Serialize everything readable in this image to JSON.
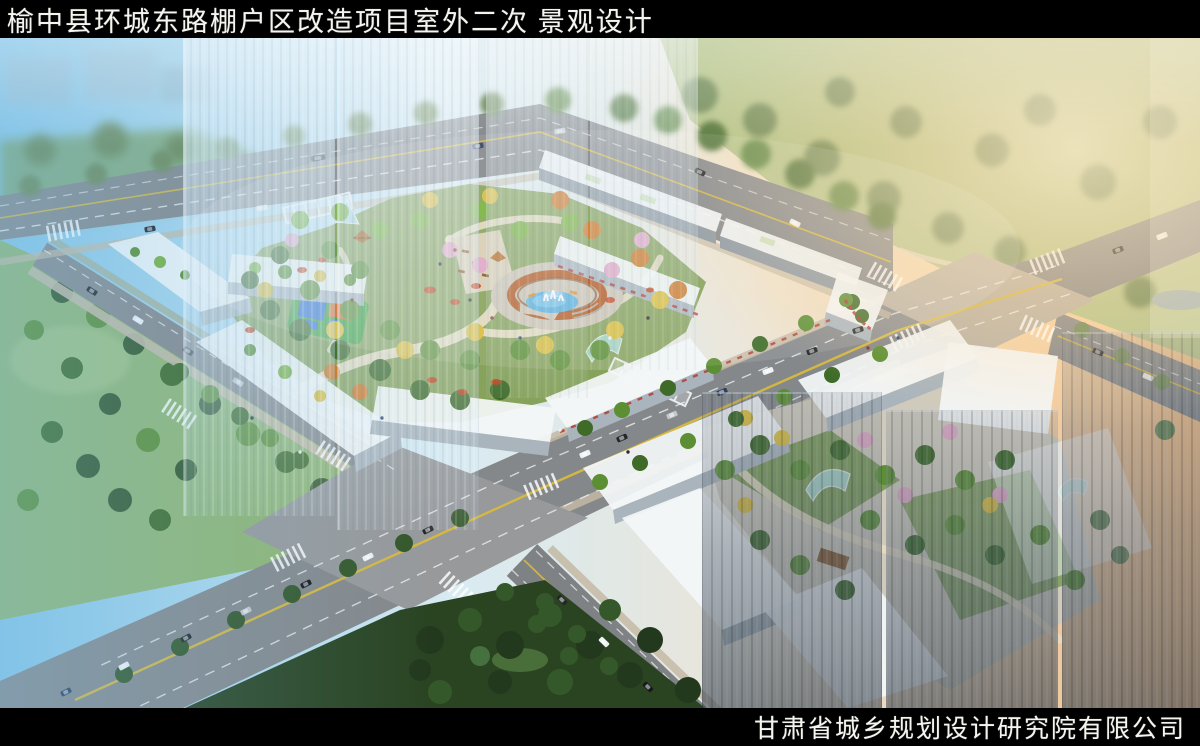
{
  "header": {
    "title": "榆中县环城东路棚户区改造项目室外二次 景观设计"
  },
  "footer": {
    "company": "甘肃省城乡规划设计研究院有限公司"
  },
  "scene": {
    "type": "aerial-architectural-rendering",
    "features": "residential blocks with central landscaped courtyard, semicircular pergola fountain plaza, playground, tree-lined arterial roads, two paved intersections, translucent high-rise tower massing, parks"
  },
  "colors": {
    "bar-bg": "#000000",
    "bar-text": "#f5f5f0",
    "road": "#85888b",
    "lane-yellow": "#d8b93c",
    "lane-white": "#f2f3f4",
    "plaza-sw": "#97999b",
    "plaza-ne": "#b9b2a4",
    "sidewalk": "#c4b9a4",
    "building-top": "#f3f6f8",
    "building-side": "#a9b4bc",
    "building-shadow": "#8d98a1",
    "tree-green": "#3f6b28",
    "tree-mid": "#5c8f33",
    "tree-light": "#79b13f",
    "tree-yellow": "#d9bd3e",
    "tree-orange": "#cd7827",
    "tree-pink": "#dfa8c4",
    "tree-dark": "#23391d",
    "tree-warm": "#6d8a58",
    "lawn": "#8fb573",
    "lawn-warm": "#b3c48b",
    "park-dark": "#2a4422",
    "garden-base": "#87a25b",
    "path-cream": "#e6dcc2",
    "water": "#57aedd",
    "pond": "#93a9ae",
    "fountain-ring": "#b5571d",
    "court-blue": "#2f6fd0",
    "court-orange": "#d96c2a",
    "court-green": "#3da03c",
    "flower-red": "#b0352c",
    "sky-cool": "#84c4e6",
    "sky-warm": "#f2bd85",
    "tower-light": "#e9f2f8",
    "tower-dark": "#4a545f"
  }
}
